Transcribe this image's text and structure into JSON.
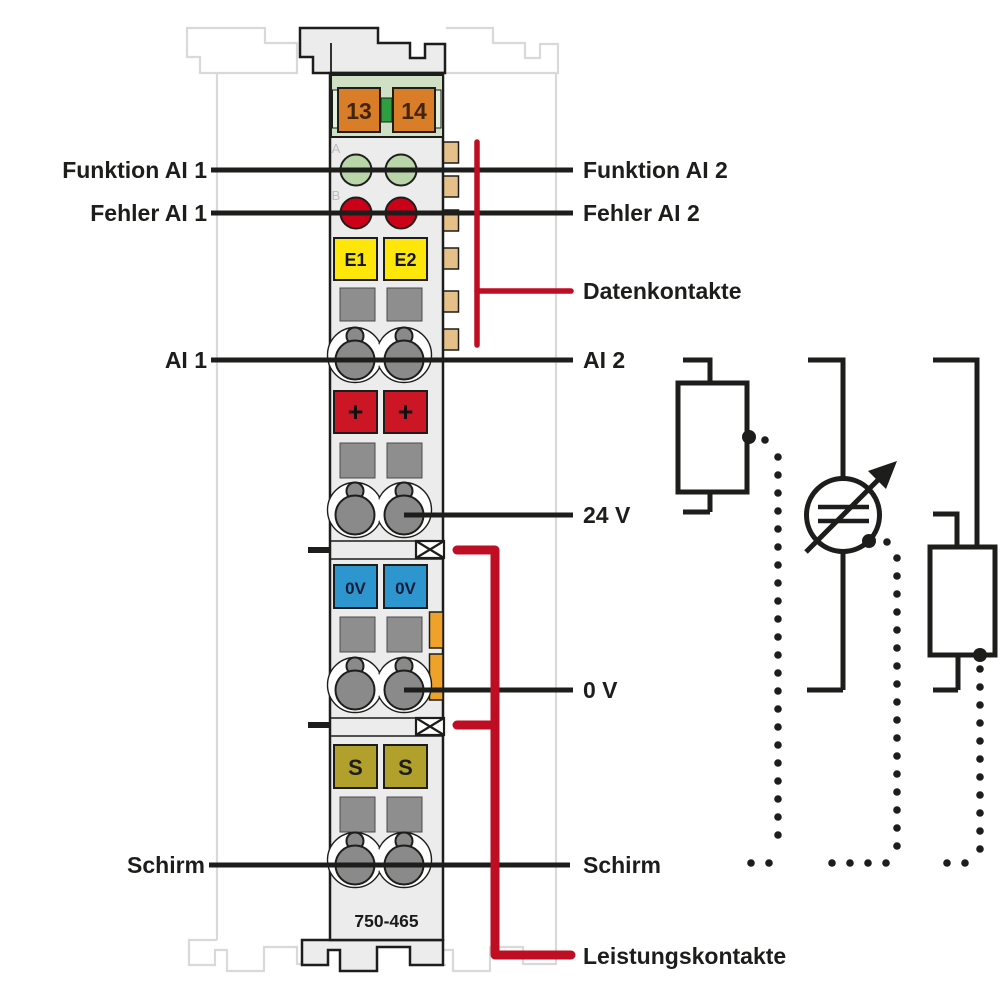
{
  "module": {
    "id": "750-465",
    "bus_terminals": [
      "13",
      "14"
    ],
    "led_letters": [
      "A",
      "B",
      "C",
      "D"
    ],
    "input_blocks": [
      "E1",
      "E2"
    ],
    "plus_blocks": [
      "+",
      "+"
    ],
    "zero_volt_blocks": [
      "0V",
      "0V"
    ],
    "shield_blocks": [
      "S",
      "S"
    ]
  },
  "labels": {
    "funktion_ai1": "Funktion AI 1",
    "fehler_ai1": "Fehler AI 1",
    "ai1": "AI 1",
    "schirm_left": "Schirm",
    "funktion_ai2": "Funktion AI 2",
    "fehler_ai2": "Fehler AI 2",
    "datenkontakte": "Datenkontakte",
    "ai2": "AI 2",
    "v24": "24 V",
    "v0": "0 V",
    "schirm_right": "Schirm",
    "leistungskontakte": "Leistungskontakte"
  },
  "colors": {
    "line_black": "#1d1d1b",
    "accent_red": "#bf0d23",
    "led_green": "#b9d6ab",
    "led_red": "#cc0018",
    "block_yellow": "#ffe60a",
    "block_red": "#cc1626",
    "block_blue": "#2d96cf",
    "block_olive": "#b1a02c",
    "block_orange": "#d97d28",
    "bus_green": "#2f9e41",
    "contact_tan": "#e6c089",
    "jumper_orange": "#efa229",
    "header_green": "#cfe0c5",
    "body_gray": "#ececec",
    "ghost_gray": "#d9d9d9"
  }
}
